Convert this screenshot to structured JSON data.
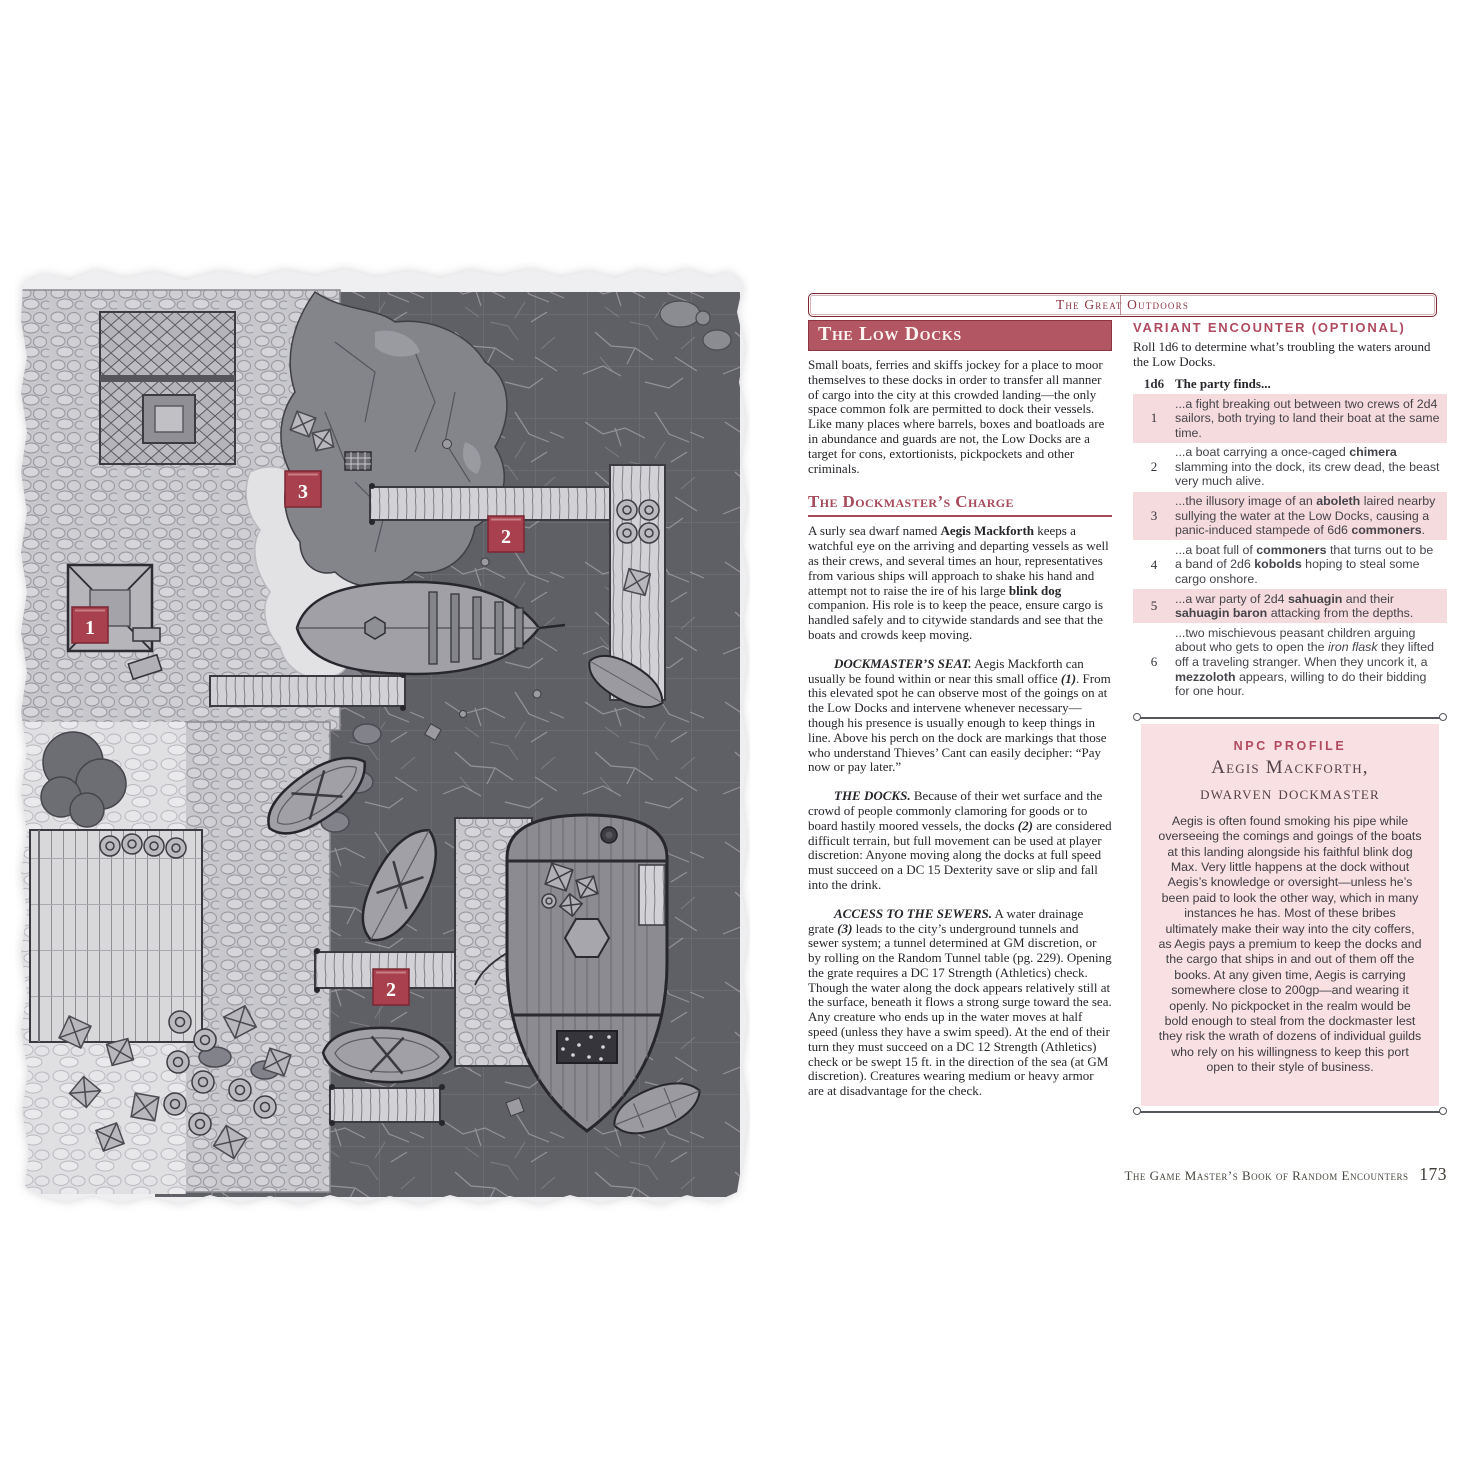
{
  "page": {
    "band_title": "The Great Outdoors",
    "footer_title": "The Game Master’s Book of Random Encounters",
    "footer_page": "173"
  },
  "colors": {
    "marker_red": "#a8414d",
    "banner_red": "#b25663",
    "heading_red": "#a84a5a",
    "table_row_pink": "#f6dbde",
    "npc_box_pink": "#f9e0e3",
    "water_gray": "#5f5f66"
  },
  "map": {
    "markers": [
      "1",
      "3",
      "2",
      "2"
    ]
  },
  "col1": {
    "title": "The Low Docks",
    "para1": "Small boats, ferries and skiffs jockey for a place to moor themselves to these docks in order to transfer all manner of cargo into the city at this crowded landing—the only space common folk are permitted to dock their vessels. Like many places where barrels, boxes and boatloads are in abundance and guards are not, the Low Docks are a target for cons, extortionists, pickpockets and other criminals.",
    "section2": "The Dockmaster’s Charge",
    "para2_segments": [
      {
        "t": "A surly sea dwarf named "
      },
      {
        "t": "Aegis Mackforth",
        "s": "b"
      },
      {
        "t": " keeps a watchful eye on the arriving and departing vessels as well as their crews, and several times an hour, representatives from various ships will approach to shake his hand and attempt not to raise the ire of his large "
      },
      {
        "t": "blink dog",
        "s": "b"
      },
      {
        "t": " companion. His role is to keep the peace, ensure cargo is handled safely and to citywide standards and see that the boats and crowds keep moving."
      }
    ],
    "para3_segments": [
      {
        "t": "DOCKMASTER’S SEAT.",
        "s": "bi"
      },
      {
        "t": " Aegis Mackforth can usually be found within or near this small office "
      },
      {
        "t": "(1)",
        "s": "bi"
      },
      {
        "t": ". From this elevated spot he can observe most of the goings on at the Low Docks and intervene whenever necessary—though his presence is usually enough to keep things in line. Above his perch on the dock are markings that those who understand Thieves’ Cant can easily decipher: “Pay now or pay later.”"
      }
    ],
    "para4_segments": [
      {
        "t": "THE DOCKS.",
        "s": "bi"
      },
      {
        "t": " Because of their wet surface and the crowd of people commonly clamoring for goods or to board hastily moored vessels, the docks "
      },
      {
        "t": "(2)",
        "s": "bi"
      },
      {
        "t": " are considered difficult terrain, but full movement can be used at player discretion: Anyone moving along the docks at full speed must succeed on a DC 15 Dexterity save or slip and fall into the drink."
      }
    ],
    "para5_segments": [
      {
        "t": "ACCESS TO THE SEWERS.",
        "s": "bi"
      },
      {
        "t": " A water drainage grate "
      },
      {
        "t": "(3)",
        "s": "bi"
      },
      {
        "t": " leads to the city’s underground tunnels and sewer system; a tunnel determined at GM discretion, or by rolling on the Random Tunnel table (pg. 229). Opening the grate requires a DC 17 Strength (Athletics) check. Though the water along the dock appears relatively still at the surface, beneath it flows a strong surge toward the sea. Any creature who ends up in the water moves at half speed (unless they have a swim speed). At the end of their turn they must succeed on a DC 12 Strength (Athletics) check or be swept 15 ft. in the direction of the sea (at GM discretion). Creatures wearing medium or heavy armor are at disadvantage for the check."
      }
    ]
  },
  "variant": {
    "heading": "Variant Encounter (Optional)",
    "intro": "Roll 1d6 to determine what’s troubling the waters around the Low Docks.",
    "col_die": "1d6",
    "col_find": "The party finds...",
    "rows": [
      {
        "die": "1",
        "alt": true,
        "segments": [
          {
            "t": "...a fight breaking out between two crews of 2d4 sailors, both trying to land their boat at the same time."
          }
        ]
      },
      {
        "die": "2",
        "alt": false,
        "segments": [
          {
            "t": "...a boat carrying a once-caged "
          },
          {
            "t": "chimera",
            "s": "b"
          },
          {
            "t": " slamming into the dock, its crew dead, the beast very much alive."
          }
        ]
      },
      {
        "die": "3",
        "alt": true,
        "segments": [
          {
            "t": "...the illusory image of an "
          },
          {
            "t": "aboleth",
            "s": "b"
          },
          {
            "t": " laired nearby sullying the water at the Low Docks, causing a panic-induced stampede of 6d6 "
          },
          {
            "t": "commoners",
            "s": "b"
          },
          {
            "t": "."
          }
        ]
      },
      {
        "die": "4",
        "alt": false,
        "segments": [
          {
            "t": "...a boat full of "
          },
          {
            "t": "commoners",
            "s": "b"
          },
          {
            "t": " that turns out to be a band of 2d6 "
          },
          {
            "t": "kobolds",
            "s": "b"
          },
          {
            "t": " hoping to steal some cargo onshore."
          }
        ]
      },
      {
        "die": "5",
        "alt": true,
        "segments": [
          {
            "t": "...a war party of 2d4 "
          },
          {
            "t": "sahuagin",
            "s": "b"
          },
          {
            "t": " and their "
          },
          {
            "t": "sahuagin baron",
            "s": "b"
          },
          {
            "t": " attacking from the depths."
          }
        ]
      },
      {
        "die": "6",
        "alt": false,
        "segments": [
          {
            "t": "...two mischievous peasant children arguing about who gets to open the "
          },
          {
            "t": "iron flask",
            "s": "i"
          },
          {
            "t": " they lifted off a traveling stranger. When they uncork it, a "
          },
          {
            "t": "mezzoloth",
            "s": "b"
          },
          {
            "t": " appears, willing to do their bidding for one hour."
          }
        ]
      }
    ]
  },
  "npc": {
    "kicker": "NPC Profile",
    "name": "Aegis Mackforth,",
    "role": "dwarven dockmaster",
    "body": "Aegis is often found smoking his pipe while overseeing the comings and goings of the boats at this landing alongside his faithful blink dog Max. Very little happens at the dock without Aegis’s knowledge or oversight—unless he’s been paid to look the other way, which in many instances he has. Most of these bribes ultimately make their way into the city coffers, as Aegis pays a premium to keep the docks and the cargo that ships in and out of them off the books. At any given time, Aegis is carrying somewhere close to 200gp—and wearing it openly. No pickpocket in the realm would be bold enough to steal from the dockmaster lest they risk the wrath of dozens of individual guilds who rely on his willingness to keep this port open to their style of business."
  }
}
